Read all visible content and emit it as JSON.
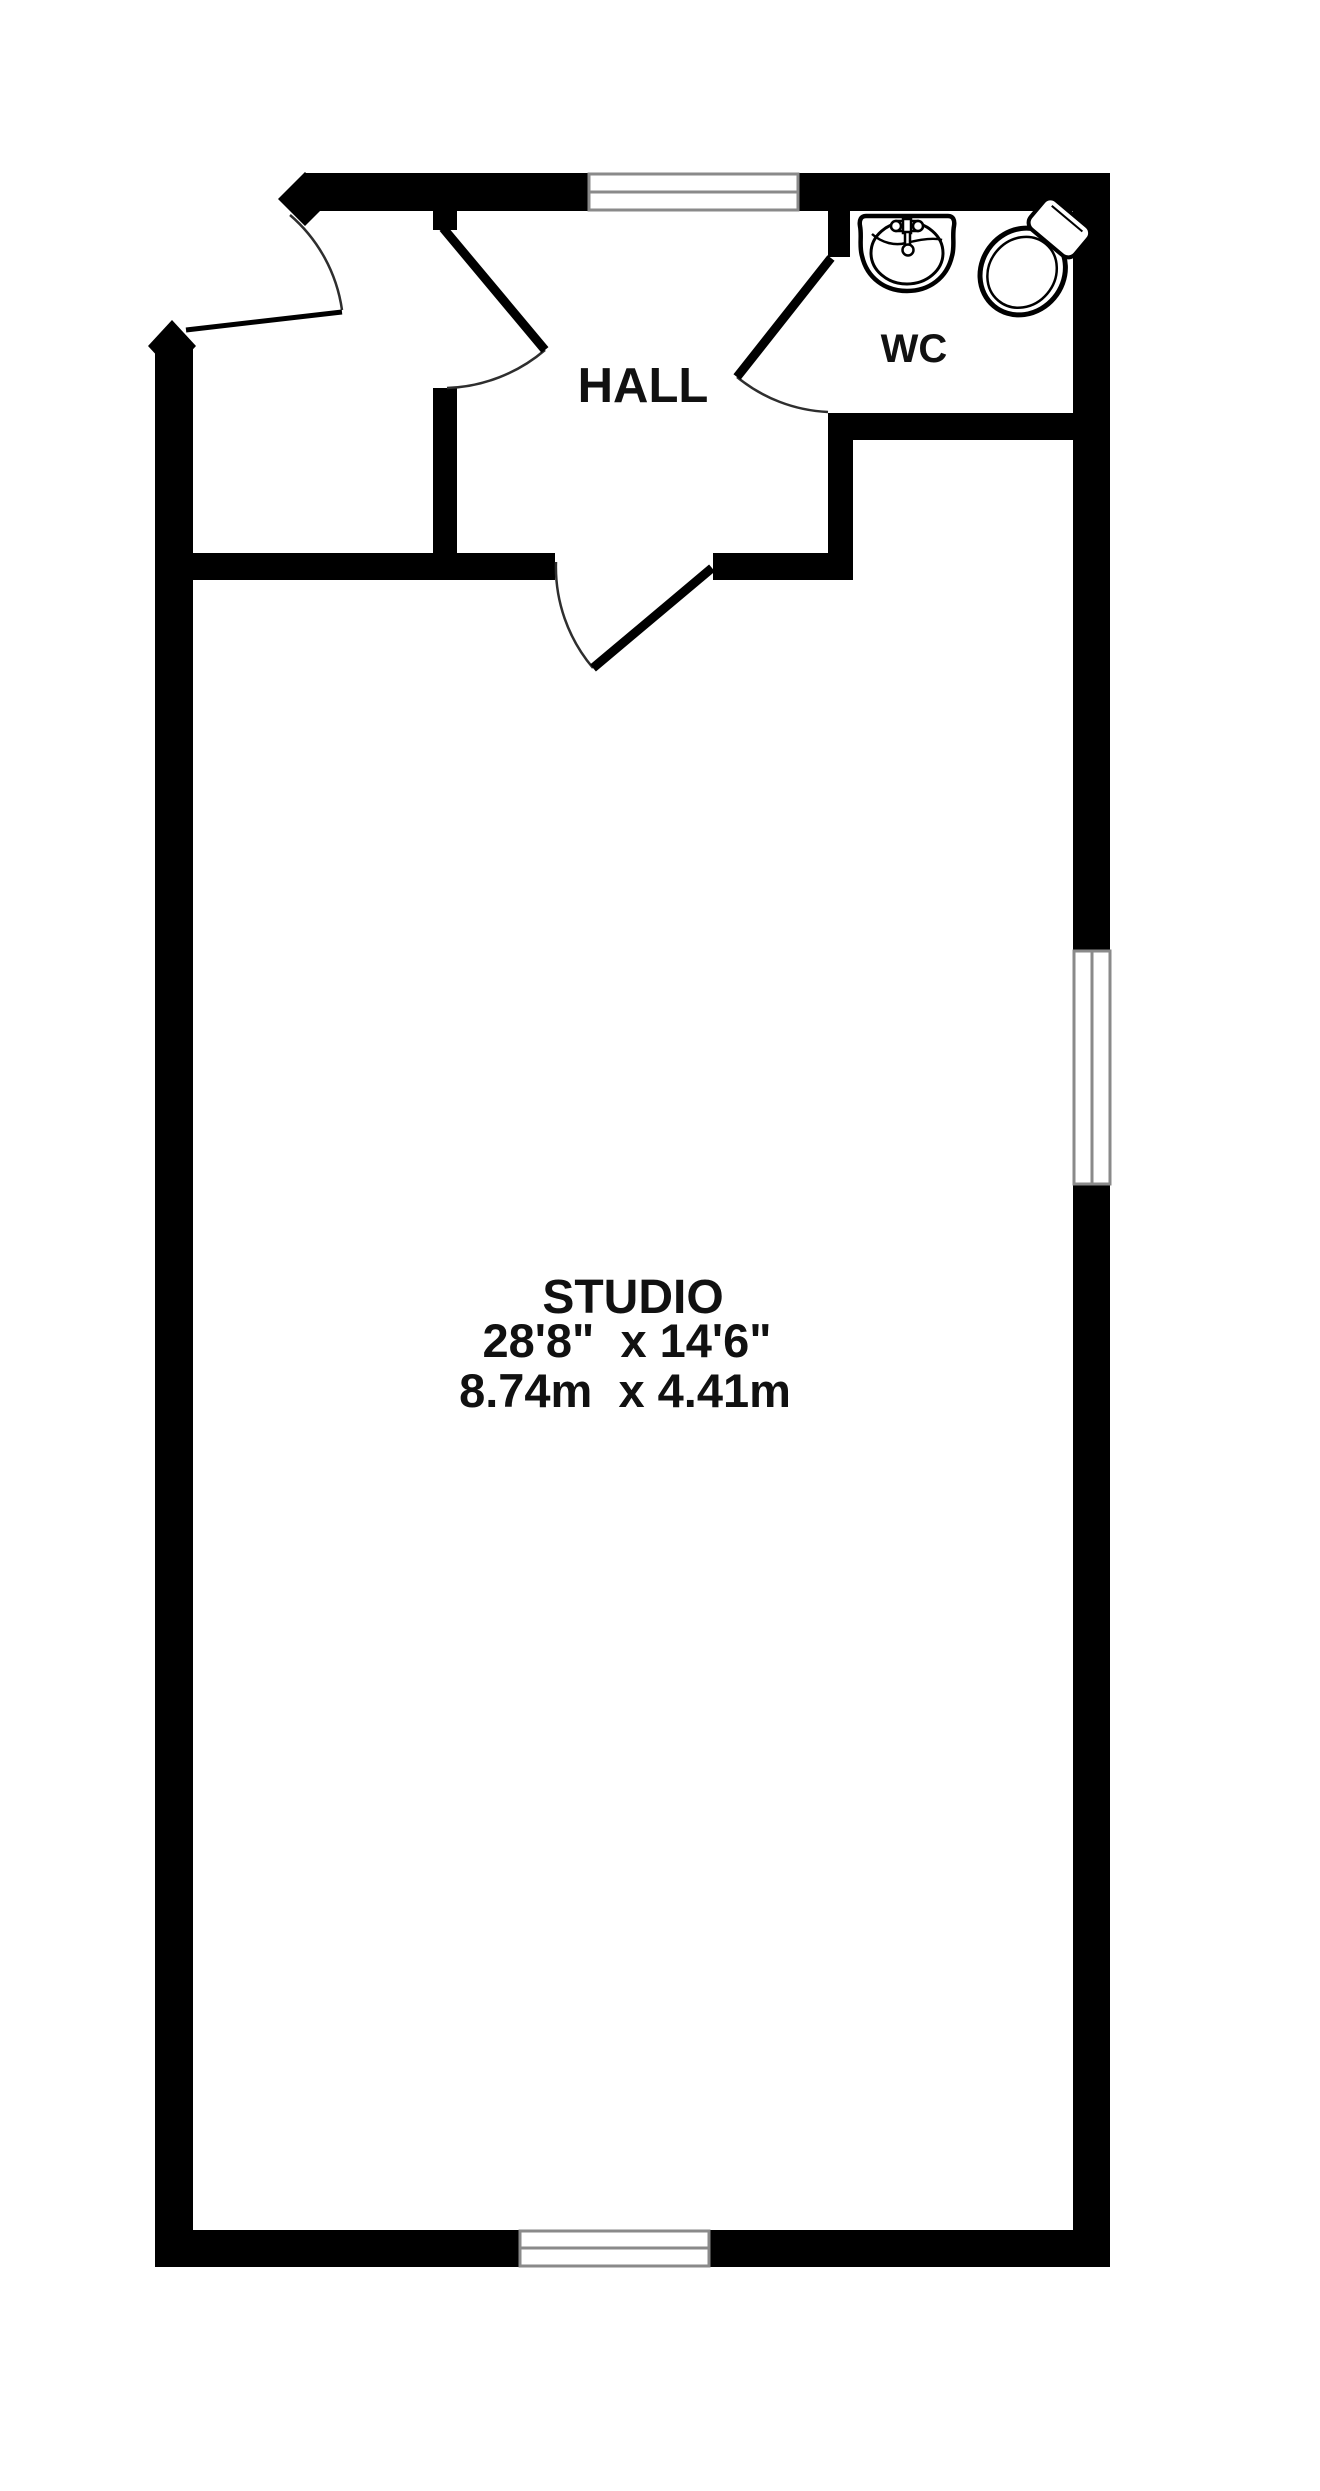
{
  "floor_plan": {
    "hall": {
      "label": "HALL"
    },
    "wc": {
      "label": "WC"
    },
    "studio": {
      "label": "STUDIO",
      "dimensions_imperial": "28'8\"  x 14'6\"",
      "dimensions_metric": "8.74m  x 4.41m"
    },
    "fixtures": {
      "sink": "sink",
      "toilet": "toilet"
    },
    "windows": {
      "count": 3,
      "locations": "top wall, right wall, bottom wall"
    },
    "doors": {
      "count": 4,
      "locations": "entrance, vestibule-to-hall, wc, studio"
    },
    "colors": {
      "wall": "#000000",
      "floor": "#ffffff",
      "window_frame": "#8a8a8a",
      "door_swing": "#2e2e2e",
      "label_text": "#111111"
    }
  }
}
